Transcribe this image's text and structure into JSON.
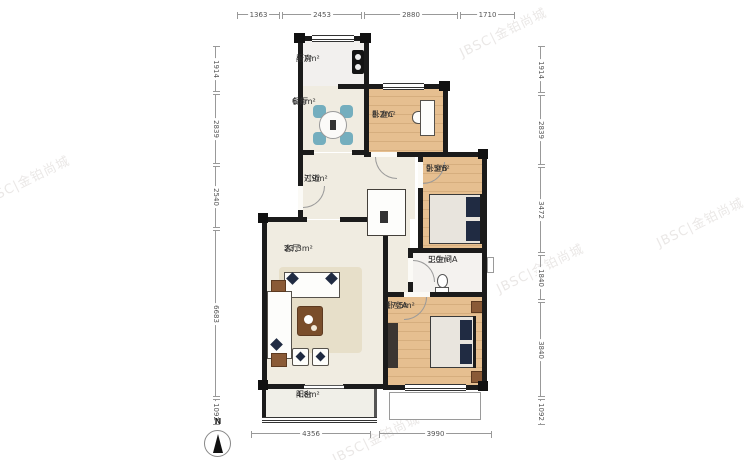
{
  "page": {
    "type": "apartment-floor-plan"
  },
  "dimensions": {
    "top": [
      "1363",
      "2453",
      "2880",
      "1710"
    ],
    "left": [
      "1914",
      "2839",
      "2540",
      "6683",
      "1092"
    ],
    "right": [
      "1914",
      "2839",
      "3472",
      "1840",
      "3840",
      "1092"
    ],
    "bottom": [
      "4356",
      "3990"
    ]
  },
  "rooms": {
    "kitchen": {
      "name": "厨房",
      "area": "4.7m²"
    },
    "dining": {
      "name": "餐厅",
      "area": "6.8m²"
    },
    "bedroom_c": {
      "name": "卧室C",
      "area": "8.2m²"
    },
    "hallway": {
      "name": "过道",
      "area": "7.9m²"
    },
    "bedroom_b": {
      "name": "卧室B",
      "area": "9.5m²"
    },
    "living": {
      "name": "客厅",
      "area": "23.3m²"
    },
    "bathroom_a": {
      "name": "卫生间A",
      "area": "5.0m²"
    },
    "bedroom_a": {
      "name": "卧室A",
      "area": "17.5m²"
    },
    "balcony": {
      "name": "阳台",
      "area": "4.8m²"
    }
  },
  "compass": {
    "label": "N"
  },
  "watermark": {
    "text": "JBSC|金铂尚城"
  },
  "colors": {
    "wall": "#1b1b1b",
    "wood_floor": "#e6bf90",
    "tile_floor": "#f0ece1",
    "accent_navy": "#202b42",
    "accent_teal": "#74aebe",
    "dim_line": "#999999"
  }
}
